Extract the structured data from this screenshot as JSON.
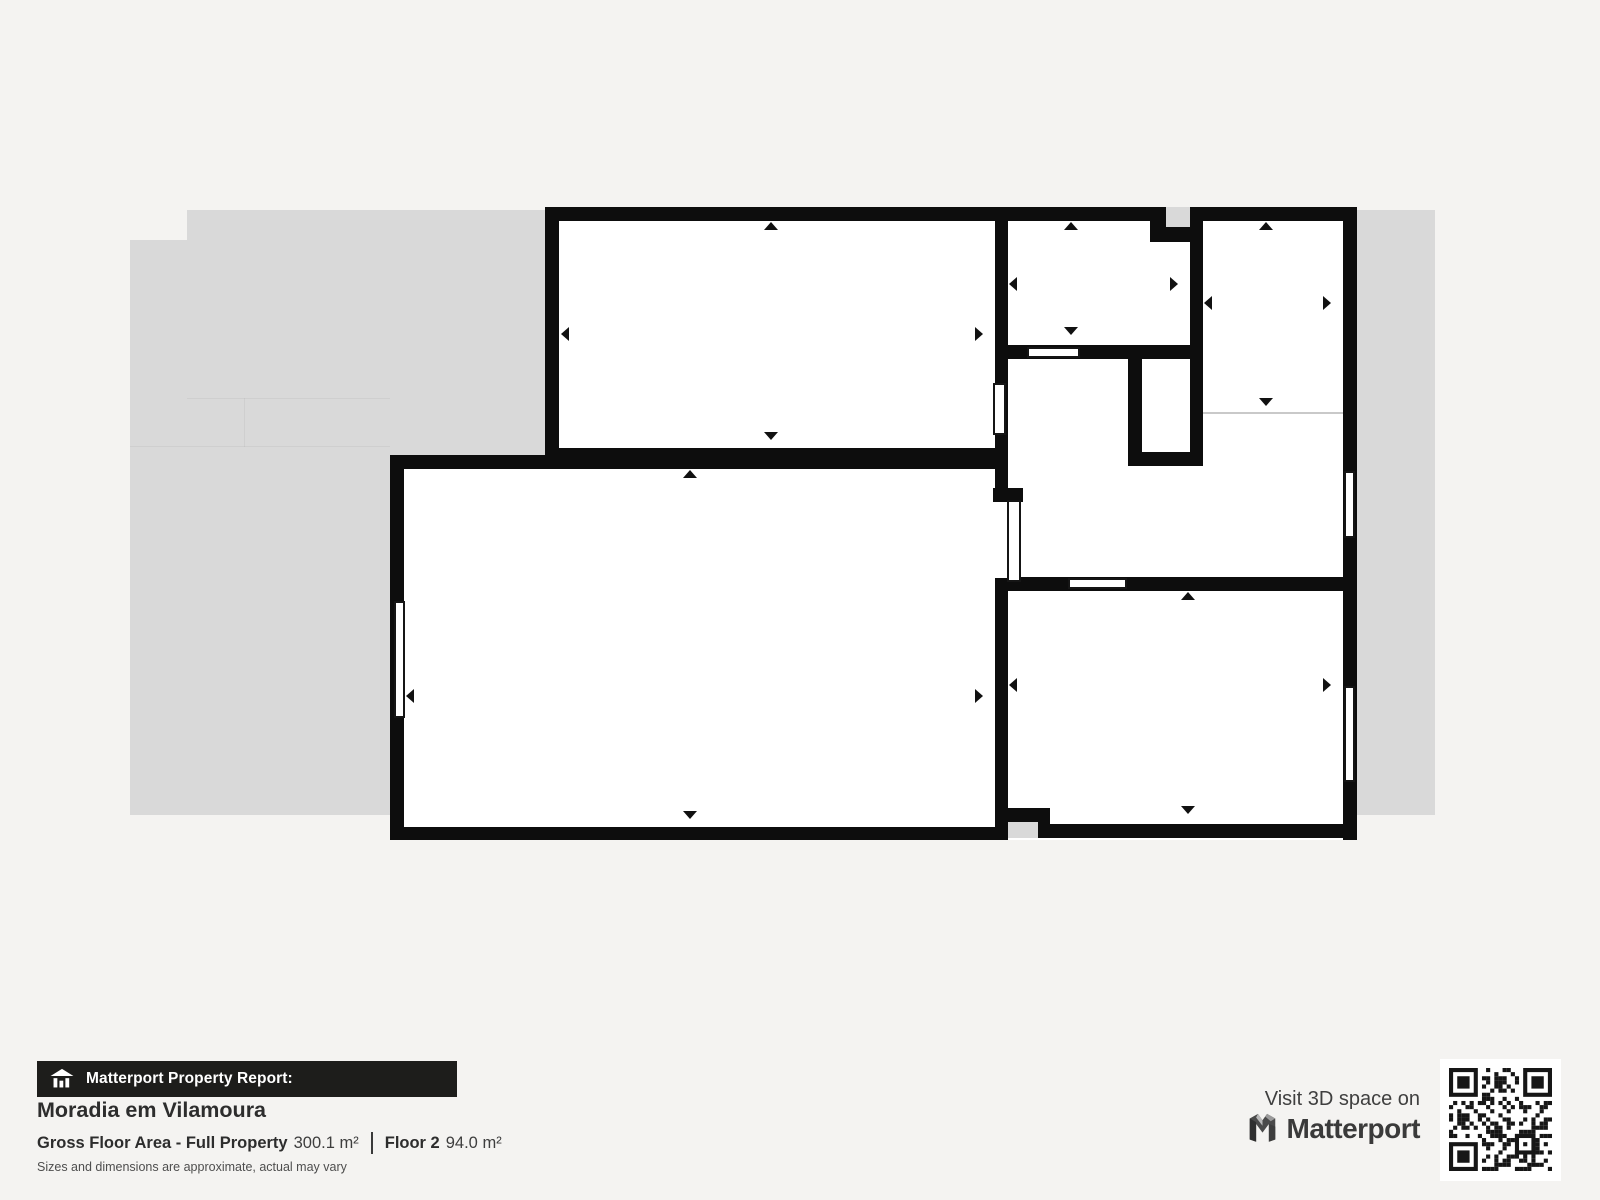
{
  "plan": {
    "rooms": [
      {
        "name": "Bedroom",
        "dims": "5.48 m × 2.91 m",
        "area": "15.9 m²"
      },
      {
        "name": "Bathroom",
        "dims": "2.33 m × 1.60 m",
        "area": "3.6 m²"
      },
      {
        "name": "Staircase",
        "dims": "1.77 m × 2.43 m",
        "area": "4.3 m²"
      },
      {
        "name": "Hallway",
        "dims": "",
        "area": "9.3 m²"
      },
      {
        "name": "Living Room",
        "dims": "7.47 m × 4.53 m",
        "area": "34.1 m²"
      },
      {
        "name": "Kitchen",
        "dims": "4.26 m × 2.98 m",
        "area": "12.6 m²"
      }
    ],
    "colors": {
      "wall": "#0d0d0d",
      "footprint": "#d9d9d9",
      "room": "#ffffff",
      "background": "#f4f3f1"
    }
  },
  "footer": {
    "report_label": "Matterport Property Report:",
    "property_name": "Moradia em Vilamoura",
    "gross_label": "Gross Floor Area - Full Property",
    "gross_value": "300.1 m²",
    "floor_label": "Floor 2",
    "floor_value": "94.0 m²",
    "disclaimer": "Sizes and dimensions are approximate, actual may vary",
    "visit_text": "Visit 3D space on",
    "brand": "Matterport"
  },
  "icons": {
    "house_report": "house-report-icon",
    "matterport_m": "matterport-logo-icon",
    "qr": "qr-code"
  }
}
